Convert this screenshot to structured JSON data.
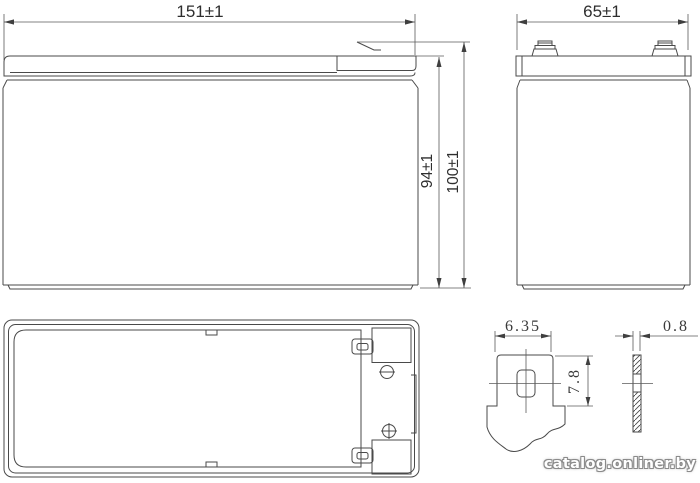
{
  "page": {
    "background": "#ffffff",
    "line_color": "#4a4a4a",
    "description": "Battery dimensional drawing"
  },
  "views": {
    "front": {
      "name": "front-view",
      "dims": {
        "width": "151±1",
        "case_height": "94±1",
        "overall_height": "100±1"
      }
    },
    "side": {
      "name": "side-view",
      "dims": {
        "depth": "65±1"
      }
    },
    "top": {
      "name": "top-view",
      "polarity_icons": [
        "minus-circle",
        "plus-circle"
      ]
    },
    "terminal": {
      "name": "terminal-detail",
      "dims": {
        "width": "6.35",
        "height": "7.8",
        "thickness": "0.8"
      }
    }
  },
  "watermark": {
    "text": "catalog.onliner.by"
  }
}
